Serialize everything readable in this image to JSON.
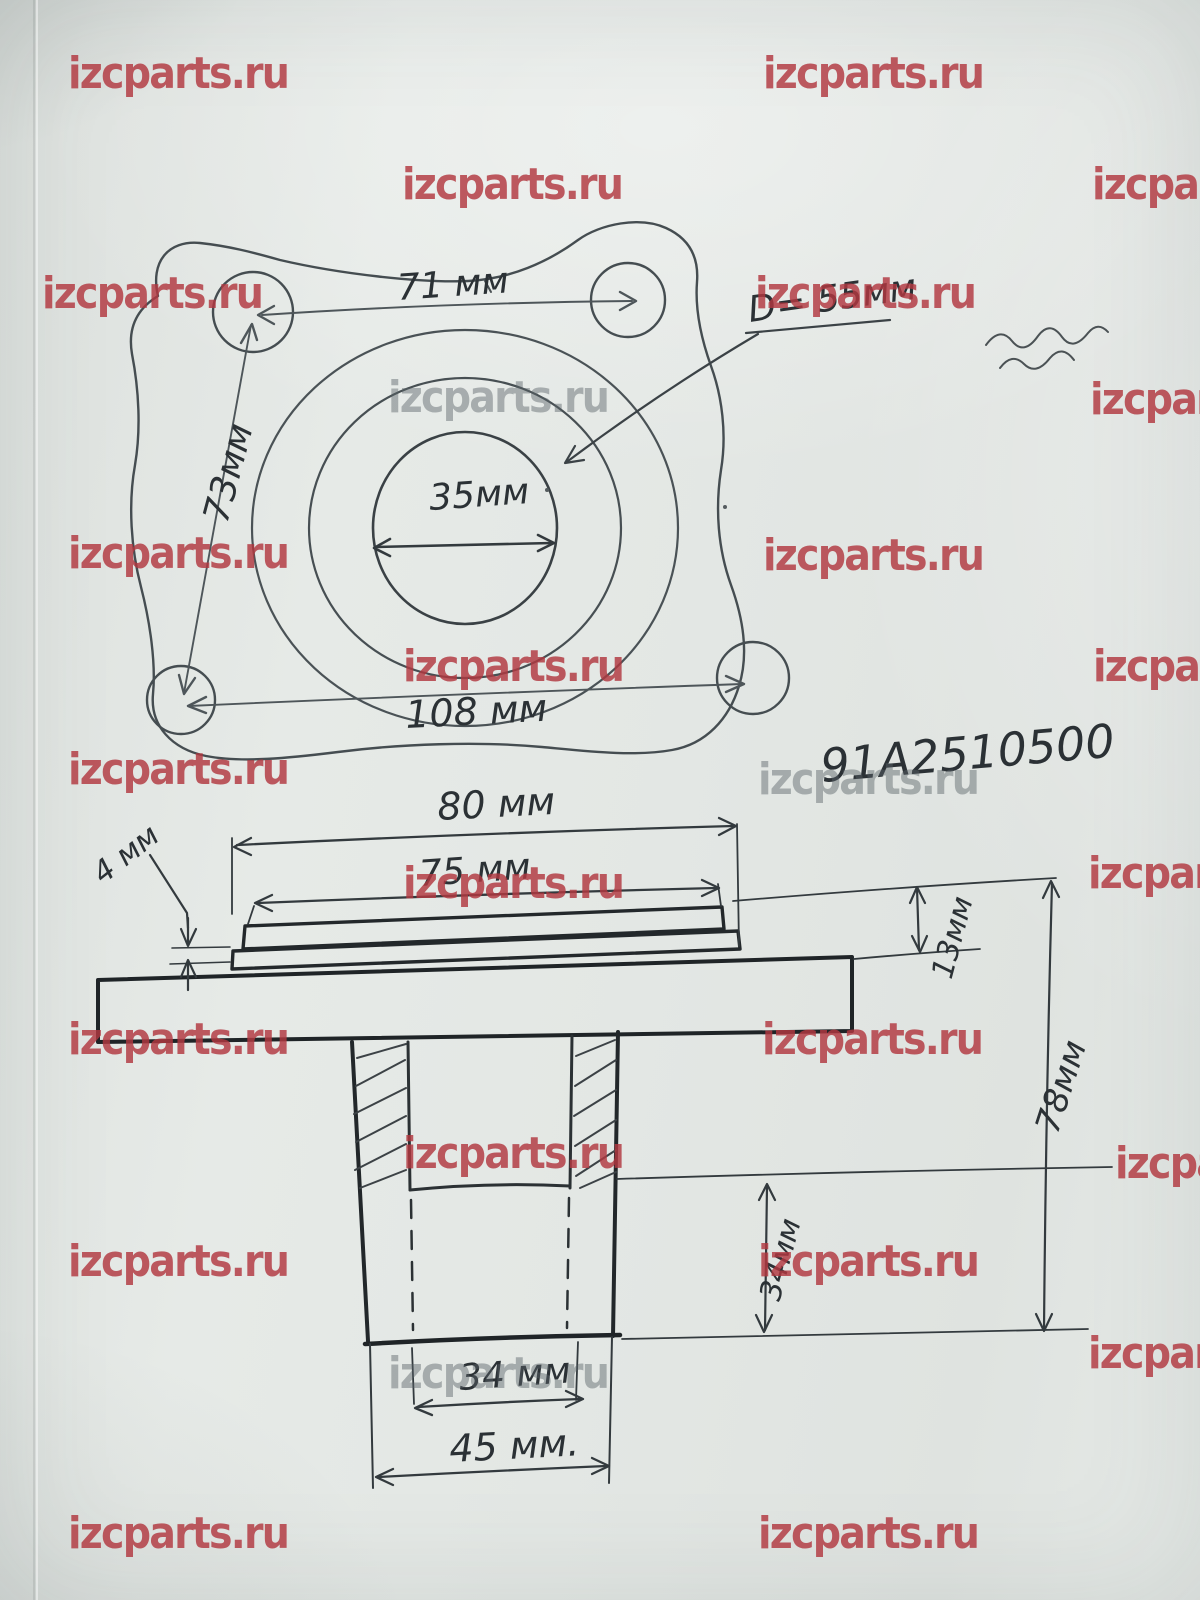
{
  "watermark": {
    "text": "izcparts.ru",
    "red_color": "#b23840",
    "gray_color": "#5a6368",
    "instances": [
      {
        "x": 68,
        "y": 52,
        "variant": "red"
      },
      {
        "x": 763,
        "y": 52,
        "variant": "red"
      },
      {
        "x": 402,
        "y": 163,
        "variant": "red"
      },
      {
        "x": 1092,
        "y": 163,
        "variant": "red"
      },
      {
        "x": 42,
        "y": 272,
        "variant": "red"
      },
      {
        "x": 755,
        "y": 272,
        "variant": "red"
      },
      {
        "x": 388,
        "y": 376,
        "variant": "gray"
      },
      {
        "x": 1090,
        "y": 378,
        "variant": "red"
      },
      {
        "x": 68,
        "y": 532,
        "variant": "red"
      },
      {
        "x": 763,
        "y": 534,
        "variant": "red"
      },
      {
        "x": 403,
        "y": 645,
        "variant": "red"
      },
      {
        "x": 1093,
        "y": 645,
        "variant": "red"
      },
      {
        "x": 68,
        "y": 748,
        "variant": "red"
      },
      {
        "x": 758,
        "y": 758,
        "variant": "gray"
      },
      {
        "x": 403,
        "y": 862,
        "variant": "red"
      },
      {
        "x": 1088,
        "y": 852,
        "variant": "red"
      },
      {
        "x": 68,
        "y": 1018,
        "variant": "red"
      },
      {
        "x": 762,
        "y": 1018,
        "variant": "red"
      },
      {
        "x": 403,
        "y": 1132,
        "variant": "red"
      },
      {
        "x": 1115,
        "y": 1142,
        "variant": "red"
      },
      {
        "x": 68,
        "y": 1240,
        "variant": "red"
      },
      {
        "x": 758,
        "y": 1240,
        "variant": "red"
      },
      {
        "x": 388,
        "y": 1352,
        "variant": "gray"
      },
      {
        "x": 1088,
        "y": 1332,
        "variant": "red"
      },
      {
        "x": 68,
        "y": 1512,
        "variant": "red"
      },
      {
        "x": 758,
        "y": 1512,
        "variant": "red"
      }
    ]
  },
  "part_number": "91А2510500",
  "top_view": {
    "dim_top_holes": "71 мм",
    "dim_left_holes": "73мм",
    "dim_bottom_holes": "108 мм",
    "dim_bore": "35мм",
    "dim_pitch_circle": "D= 55мм"
  },
  "side_view": {
    "dim_plate_outer": "80 мм",
    "dim_plate_inner": "75 мм",
    "dim_plate_thickness": "4 мм",
    "dim_step_height": "13мм",
    "dim_total_height": "78мм",
    "dim_counterbore_depth": "34мм",
    "dim_bore": "34 мм",
    "dim_base": "45 мм."
  },
  "colors": {
    "paper": "#e2e6e3",
    "pencil": "#2e3539",
    "wm_red": "#b23840",
    "wm_gray": "#5a6368"
  }
}
